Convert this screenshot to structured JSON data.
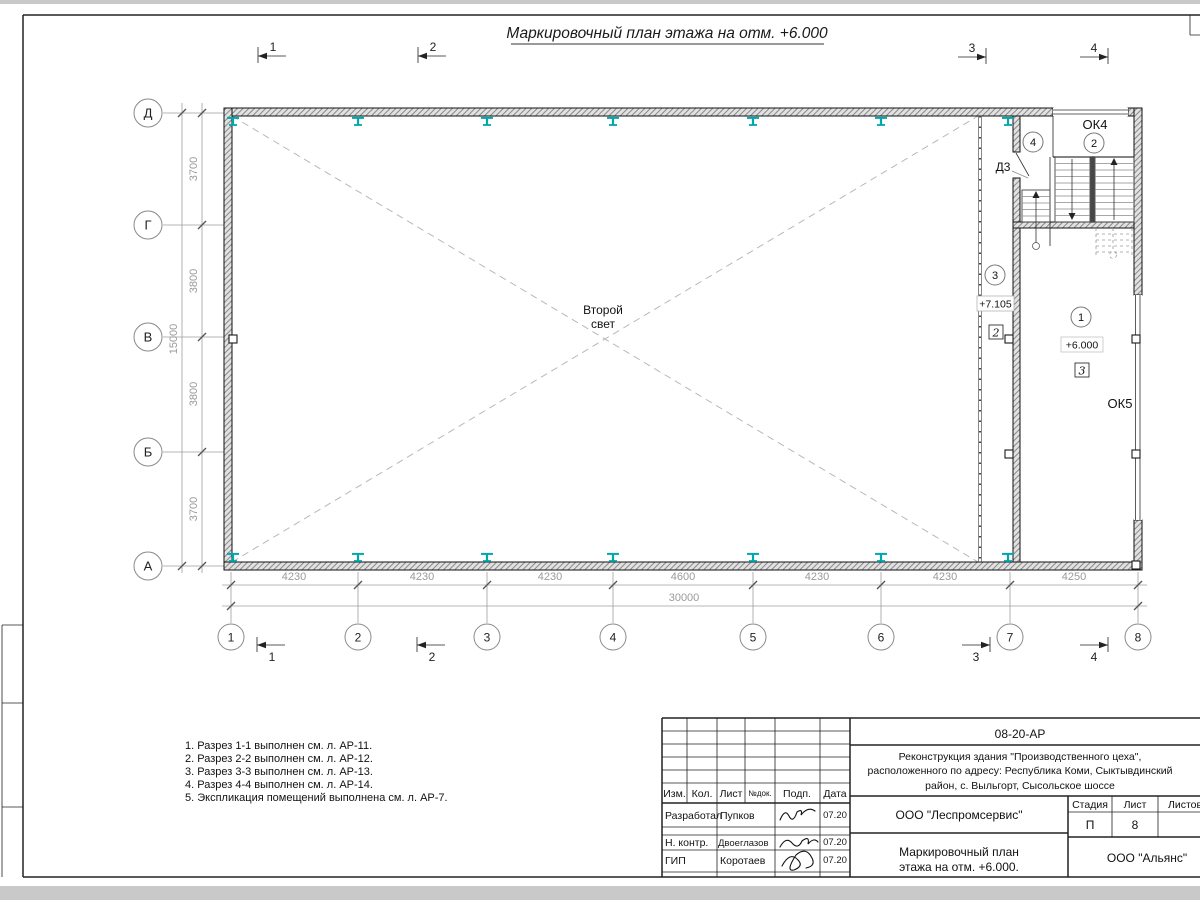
{
  "page": {
    "title": "Маркировочный план этажа на отм. +6.000"
  },
  "colors": {
    "beam_accent": "#00a7ad",
    "dim_gray": "#9a9a9a"
  },
  "plan": {
    "axes_bottom": [
      "1",
      "2",
      "3",
      "4",
      "5",
      "6",
      "7",
      "8"
    ],
    "axes_left": [
      "Д",
      "Г",
      "В",
      "Б",
      "А"
    ],
    "dims_bottom": [
      "4230",
      "4230",
      "4230",
      "4600",
      "4230",
      "4230",
      "4250"
    ],
    "dim_total_bottom": "30000",
    "dims_left": [
      "3700",
      "3800",
      "3800",
      "3700"
    ],
    "dim_total_left": "15000",
    "section_marks": {
      "s1": "1",
      "s2": "2",
      "s3": "3",
      "s4": "4"
    },
    "labels": {
      "second_light_1": "Второй",
      "second_light_2": "свет",
      "ok4": "ОК4",
      "ok5": "ОК5",
      "door_d3": "Д3",
      "elev_upper": "+7.105",
      "elev_main": "+6.000",
      "room_1": "1",
      "room_2": "2",
      "room_3": "3",
      "room_4": "4",
      "detail_2": "2",
      "detail_3": "3"
    }
  },
  "notes": {
    "line1": "1. Разрез 1-1 выполнен см. л. АР-11.",
    "line2": "2. Разрез 2-2 выполнен см. л. АР-12.",
    "line3": "3. Разрез 3-3 выполнен см. л. АР-13.",
    "line4": "4. Разрез 4-4 выполнен см. л. АР-14.",
    "line5": "5. Экспликация помещений выполнена см. л. АР-7."
  },
  "titleblock": {
    "doc_code": "08-20-АР",
    "project_1": "Реконструкция здания \"Производственного цеха\",",
    "project_2": "расположенного по адресу: Республика Коми, Сыктывдинский",
    "project_3": "район, с. Выльгорт, Сысольское шоссе",
    "col_izm": "Изм.",
    "col_kol": "Кол.",
    "col_list": "Лист",
    "col_ndok": "№док.",
    "col_podp": "Подп.",
    "col_data": "Дата",
    "row1_role": "Разработал",
    "row1_name": "Пупков",
    "row1_date": "07.20",
    "row2_role": "Н. контр.",
    "row2_name": "Двоеглазов",
    "row2_date": "07.20",
    "row3_role": "ГИП",
    "row3_name": "Коротаев",
    "row3_date": "07.20",
    "org_design": "ООО \"Леспромсервис\"",
    "sheet_title_1": "Маркировочный план",
    "sheet_title_2": "этажа на отм. +6.000.",
    "org_client": "ООО \"Альянс\"",
    "stage_label": "Стадия",
    "list_label": "Лист",
    "listov_label": "Листов",
    "stage_value": "П",
    "list_value": "8"
  }
}
